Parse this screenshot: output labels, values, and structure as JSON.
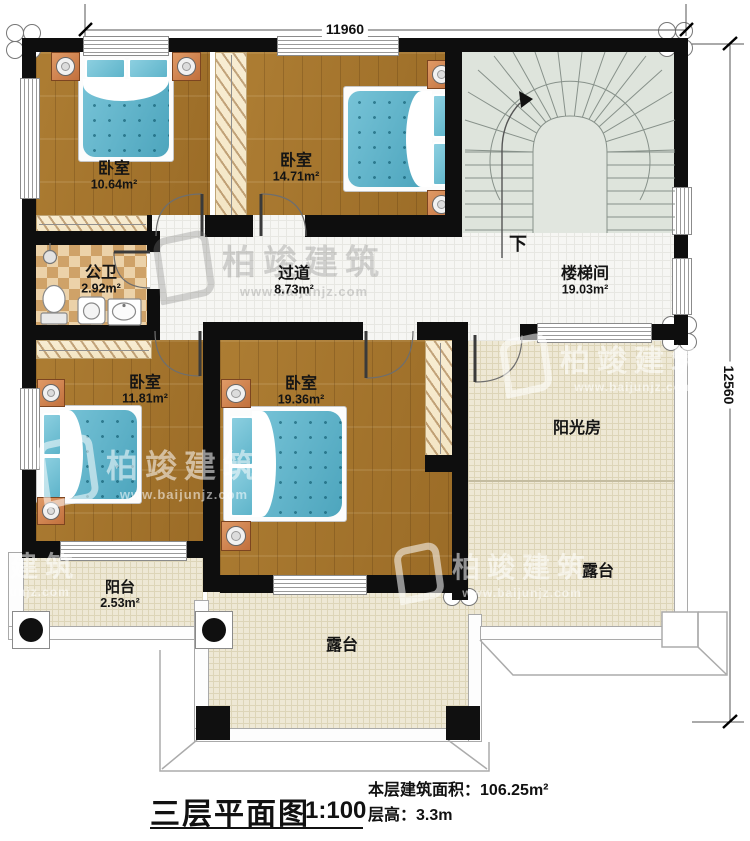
{
  "dimensions": {
    "top": "11960",
    "right": "12560"
  },
  "rooms": {
    "bedroom_top_left": {
      "name": "卧室",
      "area": "10.64m²"
    },
    "bedroom_top_middle": {
      "name": "卧室",
      "area": "14.71m²"
    },
    "stairwell": {
      "name": "楼梯间",
      "area": "19.03m²"
    },
    "bathroom": {
      "name": "公卫",
      "area": "2.92m²"
    },
    "hallway": {
      "name": "过道",
      "area": "8.73m²"
    },
    "bedroom_bottom_left": {
      "name": "卧室",
      "area": "11.81m²"
    },
    "bedroom_bottom_middle": {
      "name": "卧室",
      "area": "19.36m²"
    },
    "sunroom": {
      "name": "阳光房"
    },
    "terrace_right": {
      "name": "露台"
    },
    "terrace_bottom": {
      "name": "露台"
    },
    "balcony": {
      "name": "阳台",
      "area": "2.53m²"
    }
  },
  "stairs": {
    "direction_label": "下"
  },
  "watermark": {
    "brand": "柏竣建筑",
    "url": "www.baijunjz.com"
  },
  "title_block": {
    "title": "三层平面图",
    "scale": "1:100",
    "area_label": "本层建筑面积：",
    "area_value": "106.25m²",
    "height_label": "层高：",
    "height_value": "3.3m"
  },
  "colors": {
    "wall": "#0e0e0e",
    "wood_floor": "#a5762e",
    "tile_floor": "#f6f6f3",
    "stair_floor": "#dee4dc",
    "outdoor_floor": "#eee8d5",
    "bathroom_tile": "#cfa268",
    "bed_blue": "#5fb7cd",
    "furniture_orange": "#d4875a"
  }
}
